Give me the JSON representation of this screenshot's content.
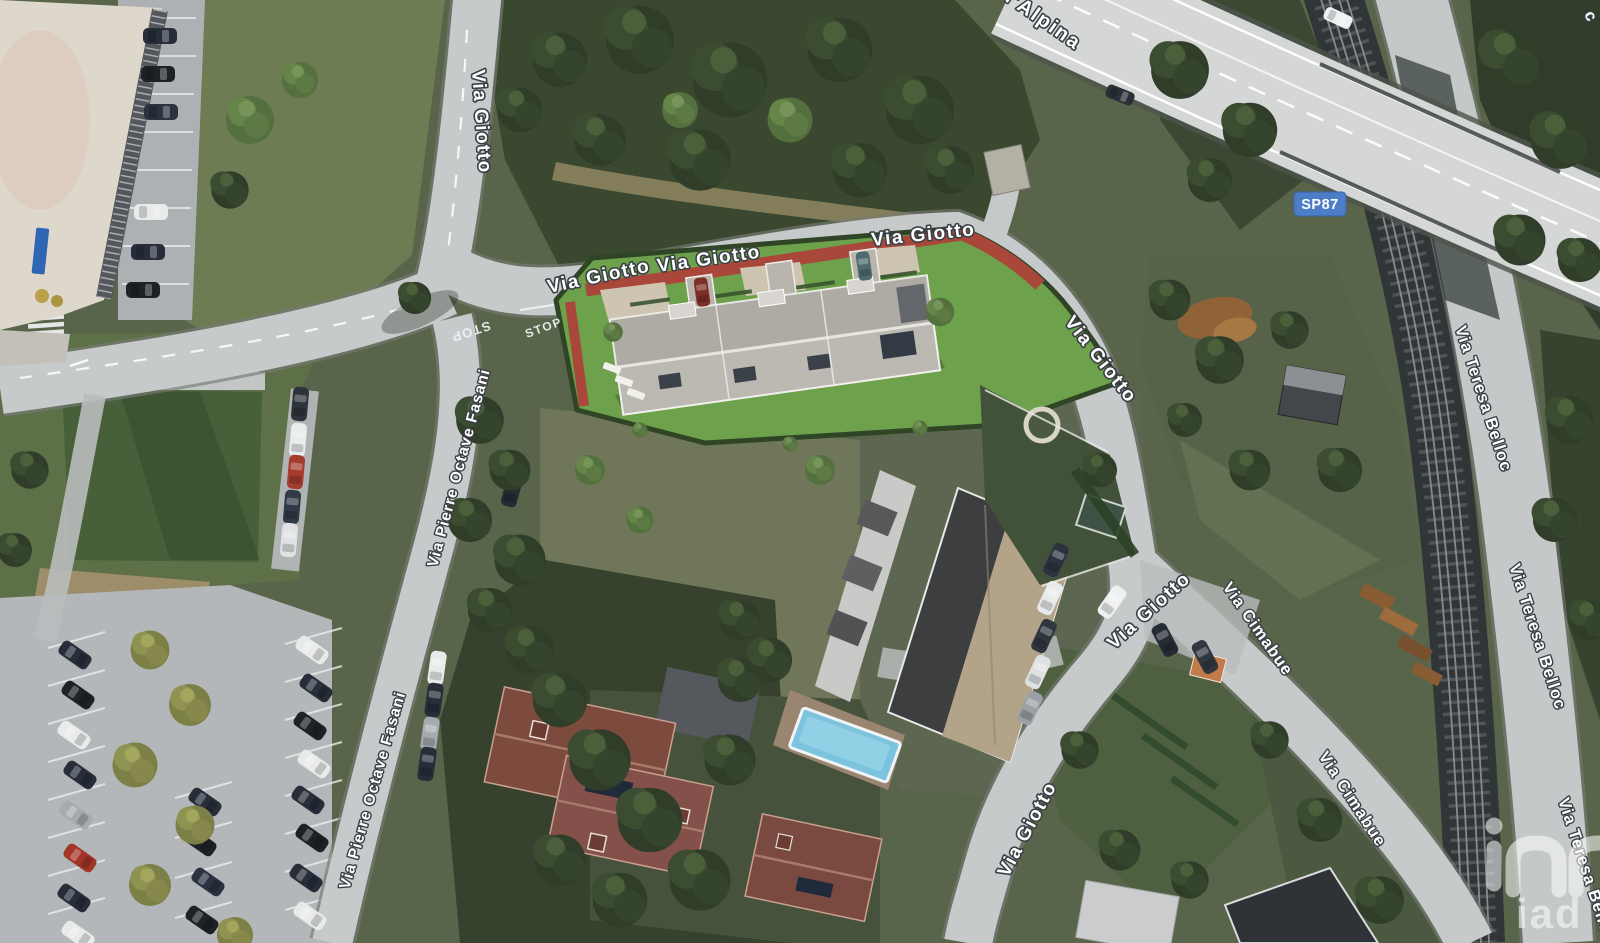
{
  "view": {
    "type": "satellite aerial map",
    "width_px": 1600,
    "height_px": 943
  },
  "labels": {
    "via_giotto": "Via Giotto",
    "via_pierre_octave_fasani": "Via Pierre Octave Fasani",
    "via_cimabue": "Via Cimabue",
    "via_teresa_belloc": "Via Teresa Belloc",
    "alpina_partial": "ll'Alpina",
    "corner_partial": "c",
    "stop_marking": "STOP"
  },
  "route_badge": {
    "text": "SP87"
  },
  "watermark": {
    "text": "iad"
  },
  "colors": {
    "badge_blue": "#4d7dc6",
    "badge_border": "#3a62a5",
    "label_fill": "#ffffff",
    "label_outline": "#3b4046",
    "road_gray": "#c7cacb",
    "highway_gray": "#d5d7d7",
    "parcel_lawn": "#6da14b",
    "brick_red": "#a8473a",
    "pool_blue": "#7cc4dd",
    "railway_dark": "#303537",
    "woods_green": "#3a4830"
  }
}
